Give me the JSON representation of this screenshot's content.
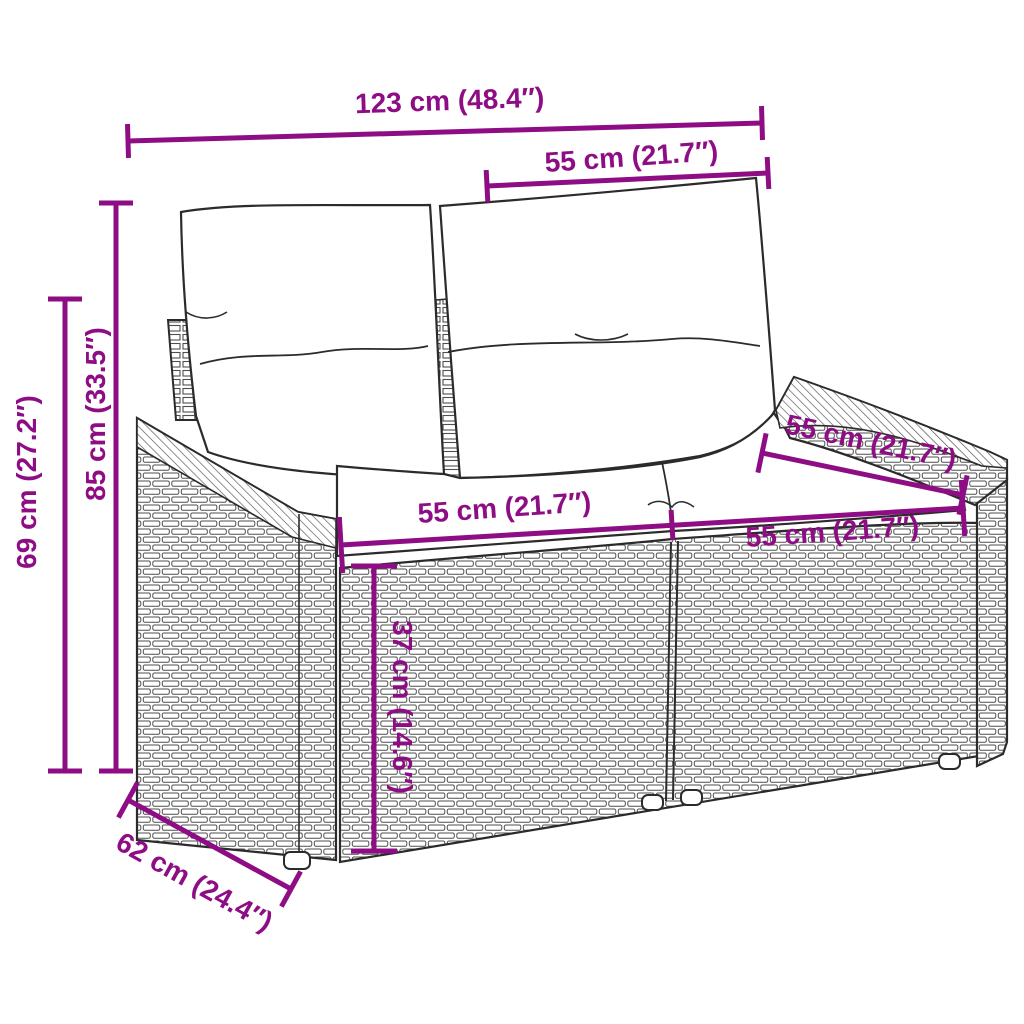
{
  "colors": {
    "background": "#ffffff",
    "dimension": "#8E0D85",
    "outline": "#2b2b2b",
    "weave_line": "#4f4f4f"
  },
  "dimensions": {
    "overall_width": {
      "label": "123 cm (48.4″)"
    },
    "backrest_width": {
      "label": "55 cm (21.7″)"
    },
    "overall_height": {
      "label": "85 cm (33.5″)"
    },
    "armrest_height": {
      "label": "69 cm (27.2″)"
    },
    "seat_width_left": {
      "label": "55 cm (21.7″)"
    },
    "seat_width_right": {
      "label": "55 cm (21.7″)"
    },
    "seat_depth": {
      "label": "55 cm (21.7″)"
    },
    "seat_height": {
      "label": "37 cm (14.6″)"
    },
    "overall_depth": {
      "label": "62 cm (24.4″)"
    }
  }
}
